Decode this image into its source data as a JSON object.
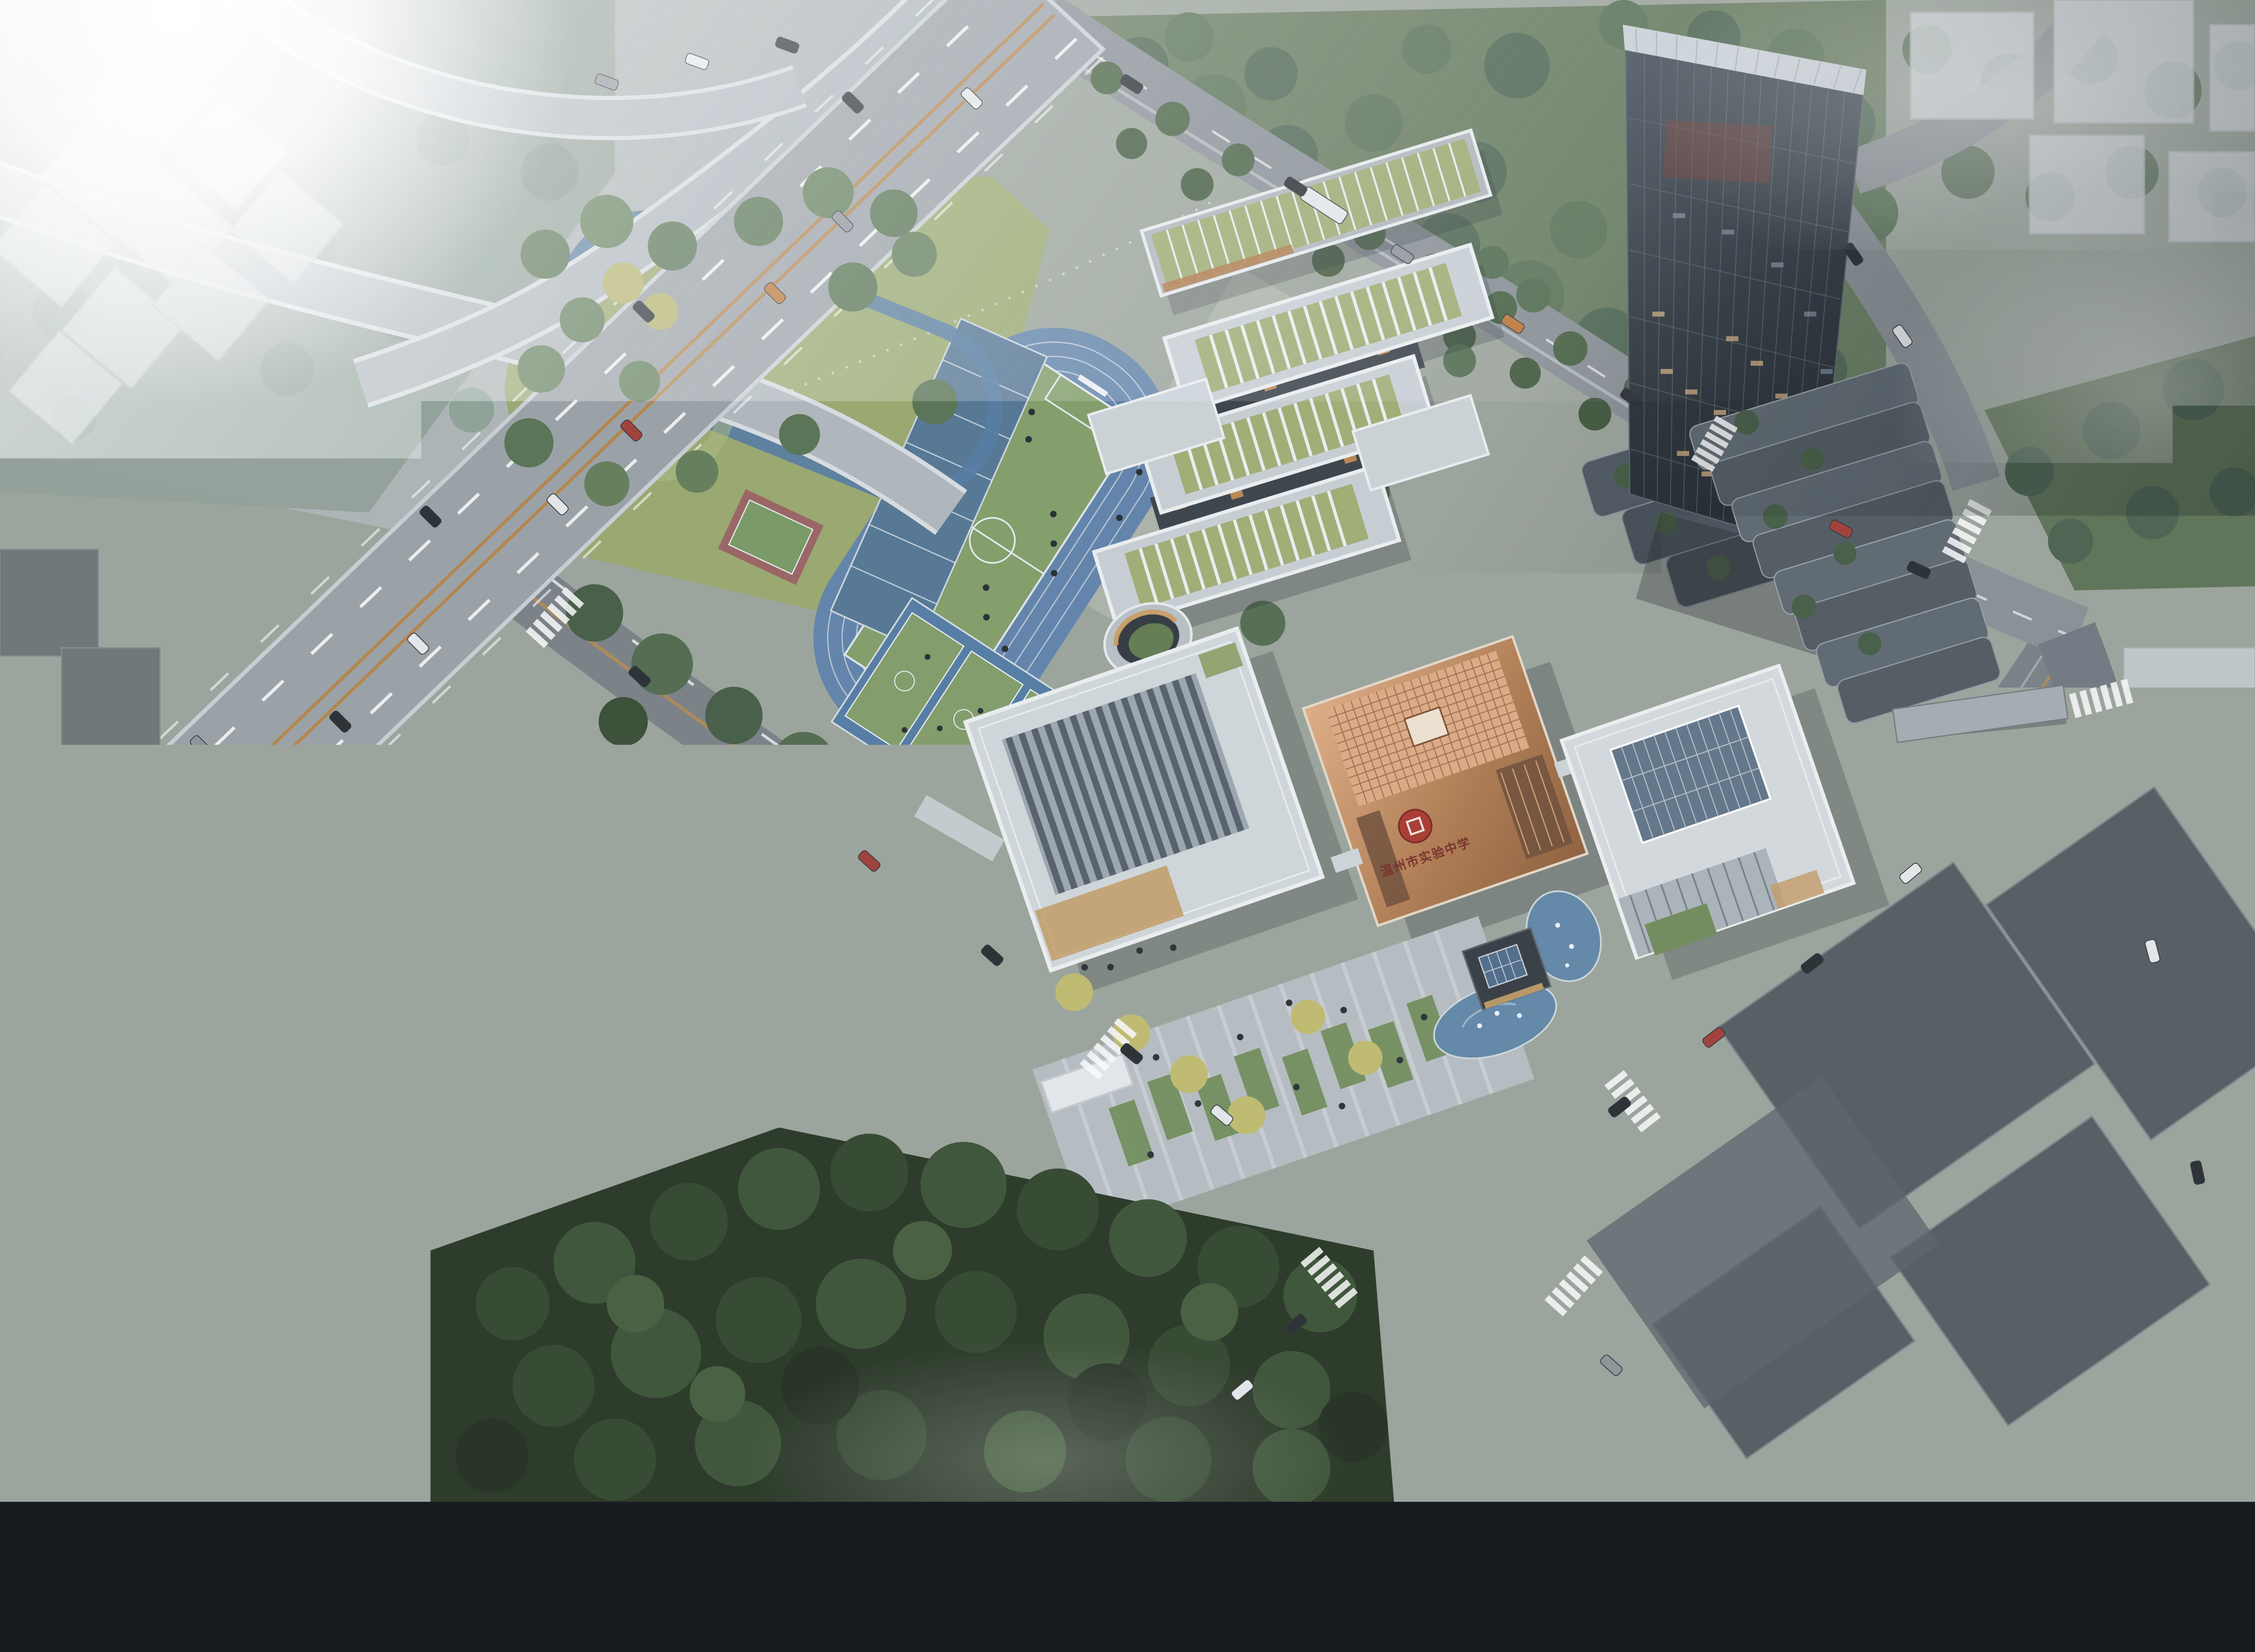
{
  "scene": {
    "type": "aerial-architectural-rendering",
    "subject": "school campus masterplan bird's-eye view at dawn with fog",
    "school_name_visible": "温州市实验中学",
    "seal_glyph": "实"
  },
  "elements": [
    "highway-interchange-upper-left",
    "sun-glare",
    "elevated-ramps",
    "running-track",
    "soccer-field",
    "badminton-strip",
    "basketball-courts",
    "court-canopy",
    "tennis-court-red-oval",
    "jogging-loop",
    "cycle-path",
    "classroom-slabs-with-green-roofs",
    "circular-sunken-courtyard",
    "gymnasium-sawtooth-roof",
    "copper-library-cube-with-seal",
    "admin-building-skylight-roof",
    "x-shaped-kindergarten",
    "entry-plaza",
    "south-gate",
    "pavilion-with-fountain-pond",
    "glass-tower",
    "terraced-podium",
    "skybridge",
    "ghost-massing-blocks",
    "dense-forest",
    "fog-patches",
    "city-roads-with-cars",
    "crosswalks"
  ],
  "palette": {
    "ground": "#9aa39b",
    "fog_white": "#ffffff",
    "highway_gray": "#99a0a7",
    "ramp_light": "#b2bac1",
    "road_gray": "#767d85",
    "road_ne": "#878e95",
    "lane_orange": "#bd8746",
    "track_blue": "#5c81ae",
    "court_pad_blue": "#4d79a7",
    "court_green": "#7d9c63",
    "field_green": "#7e9d61",
    "park_lawn": "#97a868",
    "south_lawn": "#64804f",
    "forest_dark": "#2c4128",
    "white_building": "#d2d8dd",
    "green_roof": "#9fae6e",
    "copper_light": "#e6ac80",
    "copper_dark": "#8f5a33",
    "seal_red": "#b03228",
    "tower_glass_dark": "#1b2128",
    "tower_glass_light": "#46515d",
    "ghost_light": "#d5dbdf",
    "ghost_dark": "#3f4852",
    "pond_blue": "#5b86ab",
    "plaza_gray": "#b6bdc4",
    "tennis_red": "#9c6060",
    "warm_light": "#d9b27c"
  }
}
